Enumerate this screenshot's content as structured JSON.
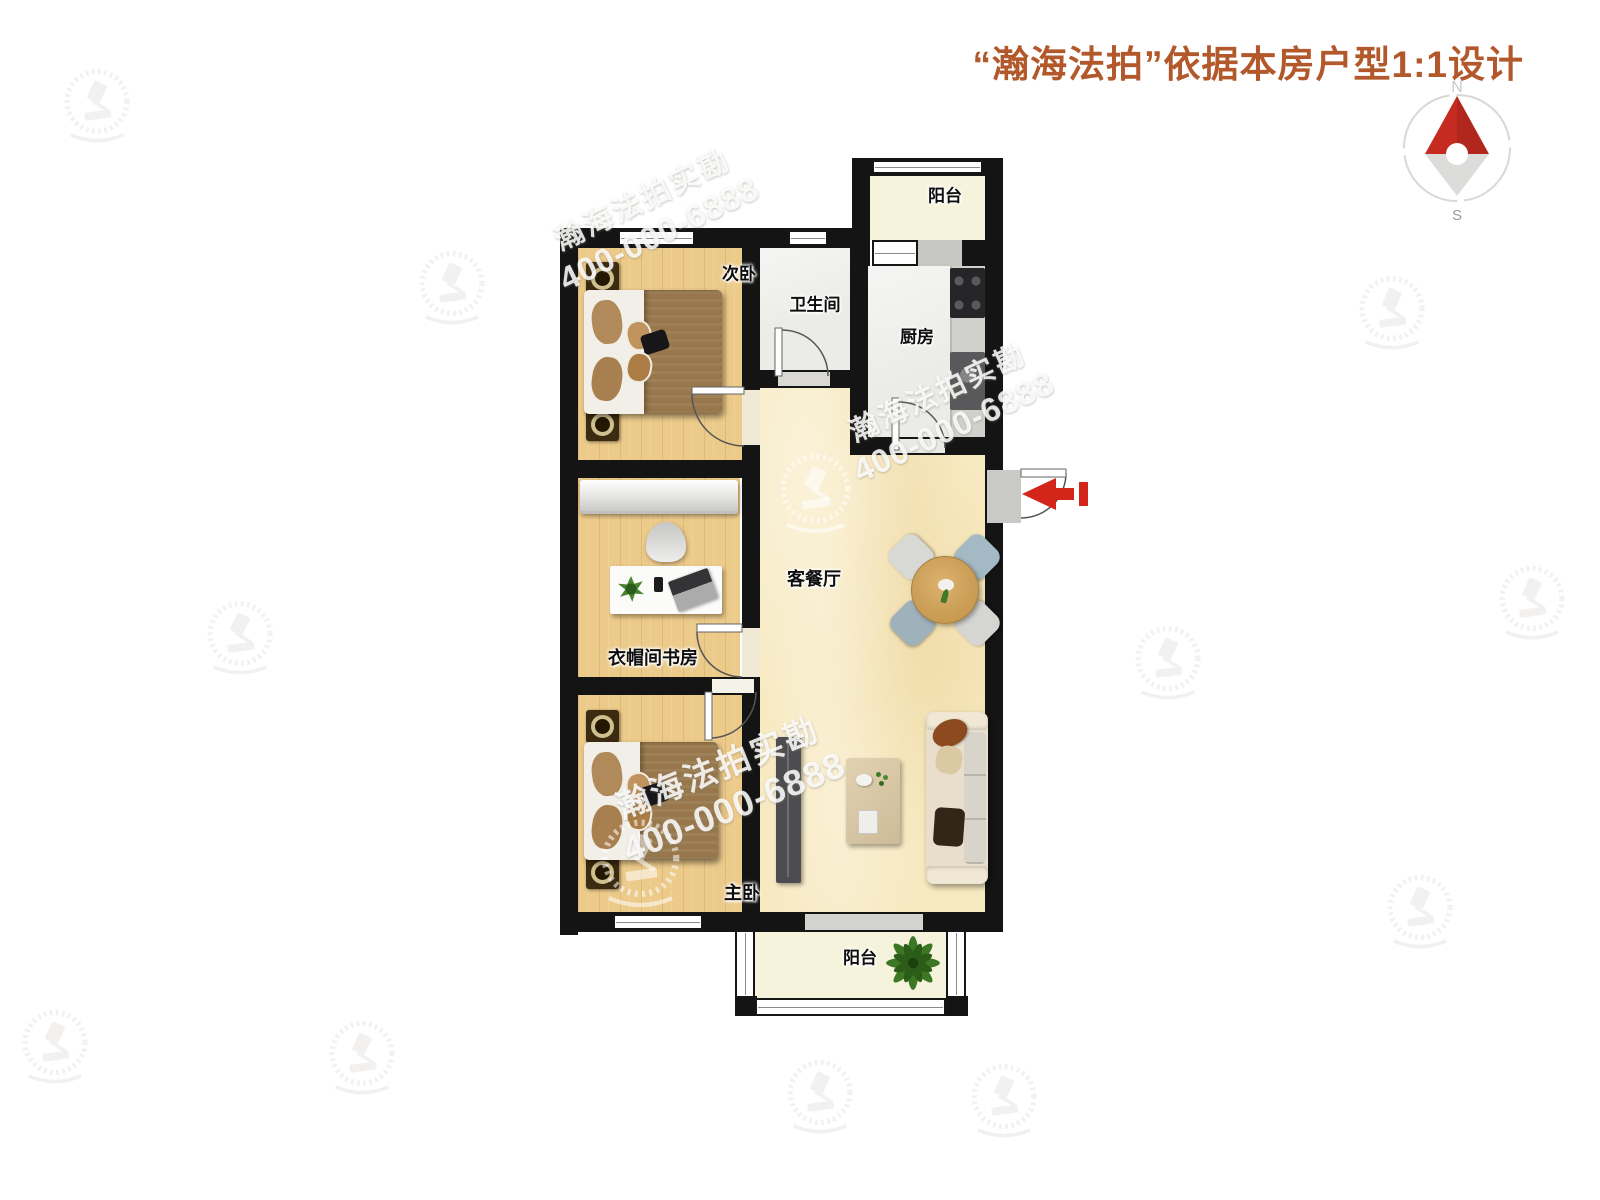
{
  "header": {
    "title": "“瀚海法拍”依据本房户型1:1设计"
  },
  "compass": {
    "north": "N",
    "south": "S"
  },
  "watermark": {
    "brand": "瀚海法拍实勘",
    "phone": "400-000-6888"
  },
  "rooms": {
    "balcony_top": "阳台",
    "secondary_bedroom": "次卧",
    "bathroom": "卫生间",
    "kitchen": "厨房",
    "living_dining": "客餐厅",
    "study": "衣帽间书房",
    "master_bedroom": "主卧",
    "balcony_bottom": "阳台"
  },
  "colors": {
    "title": "#b2582a",
    "wall": "#141414",
    "wood_floor": "#ecca8a",
    "living_floor": "#f7e9c0",
    "tile_floor": "#ebebe7",
    "balcony_floor": "#f6f3dc",
    "entry_arrow": "#d3251a",
    "compass_north": "#c62b21"
  }
}
